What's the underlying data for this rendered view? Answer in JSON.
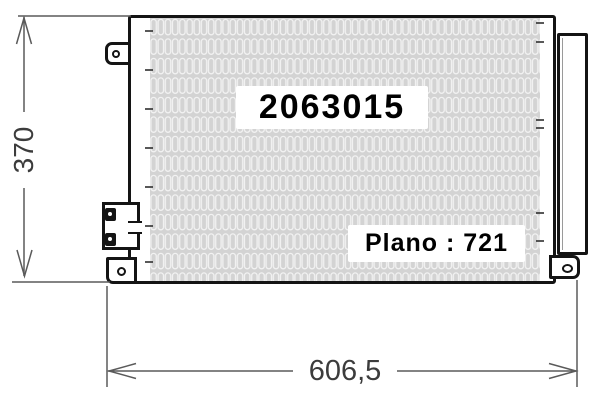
{
  "drawing": {
    "part_number": "2063015",
    "plano": "Plano : 721"
  },
  "dimensions": {
    "height": "370",
    "width": "606,5"
  },
  "colors": {
    "outline": "#141414",
    "dim-line": "#5a5a5a",
    "dim-text": "#3c3c3c",
    "core-fill": "#d3d3d3",
    "fin-stroke": "#f2f2f2",
    "label-bg": "#ffffff",
    "label-text": "#000000"
  }
}
